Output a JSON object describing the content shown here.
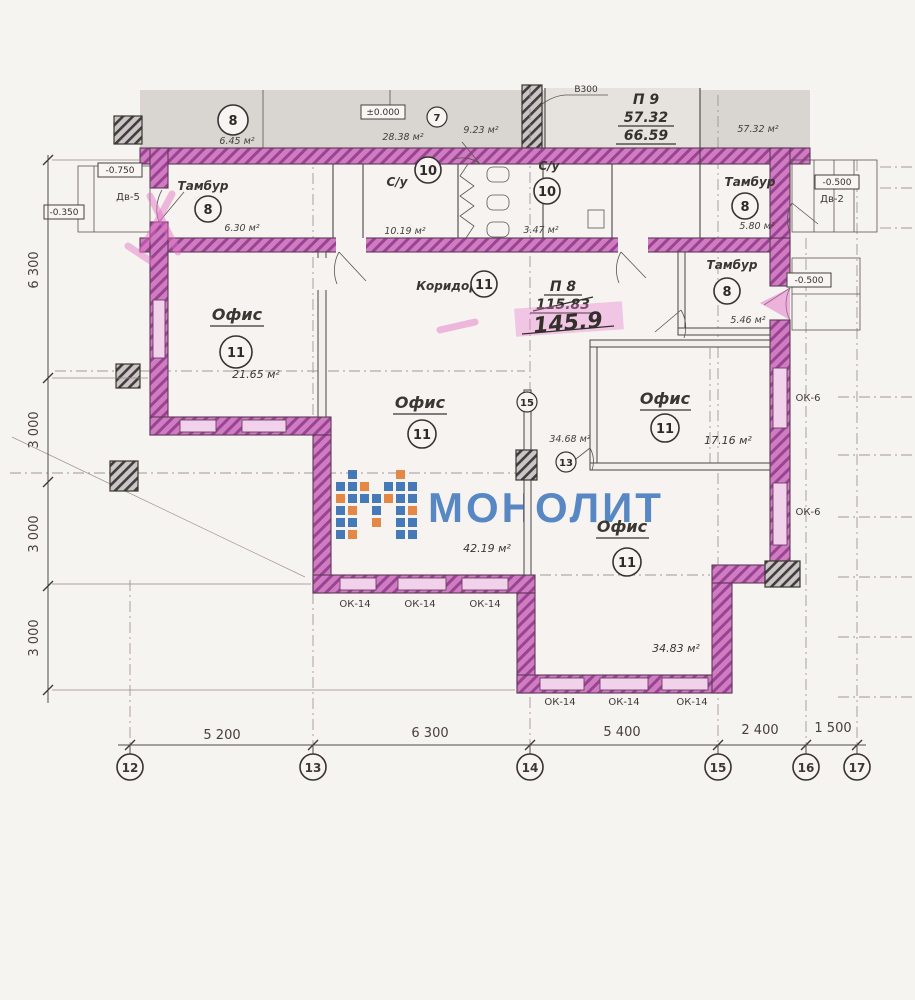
{
  "watermark": {
    "text": "МОНОЛИТ",
    "blue": "#3c72b4",
    "orange": "#e2823c"
  },
  "colors": {
    "wall_highlight": "#c766b4",
    "wall_hatch": "#9a4394",
    "window": "#f2d2ea",
    "linework": "#4a4540",
    "grey_band": "#d9d5d1"
  },
  "top": {
    "room8": {
      "num": "8",
      "area": "6.45 м²"
    },
    "area1": "28.38 м²",
    "area2": "9.23 м²",
    "level": "±0.000",
    "door7": "7",
    "note": "В300",
    "p9": {
      "label": "П 9",
      "top": "57.32",
      "bottom": "66.59"
    },
    "area_right": "57.32 м²"
  },
  "rooms": {
    "tambur_left": {
      "label": "Тамбур",
      "num": "8",
      "area": "6.30 м²"
    },
    "su_center": {
      "label": "С/у",
      "num": "10",
      "area": "10.19 м²"
    },
    "su_right": {
      "label": "С/у",
      "num": "10",
      "area": "3.47 м²"
    },
    "tambur_topright": {
      "label": "Тамбур",
      "num": "8",
      "area": "5.80 м²"
    },
    "tambur_right": {
      "label": "Тамбур",
      "num": "8",
      "area": "5.46 м²"
    },
    "corridor": {
      "label": "Коридор",
      "num": "11"
    },
    "office_left": {
      "label": "Офис",
      "num": "11",
      "area": "21.65 м²"
    },
    "office_center": {
      "label": "Офис",
      "num": "11",
      "area": "42.19 м²"
    },
    "office_right": {
      "label": "Офис",
      "num": "11",
      "area": "17.16 м²"
    },
    "office_bottom": {
      "label": "Офис",
      "num": "11",
      "area": "34.83 м²"
    },
    "area_mid": "34.68 м²"
  },
  "p8": {
    "label": "П 8",
    "old": "115.83",
    "new": "145.9"
  },
  "doors": {
    "dv5": "Дв-5",
    "dv2": "Дв-2",
    "m13": "13",
    "m15": "15"
  },
  "windows": {
    "ok14": "ОК-14",
    "ok6": "ОК-6"
  },
  "levels": {
    "left_upper": "-0.750",
    "left_lower": "-0.350",
    "right_top": "-0.500",
    "right_mid": "-0.500"
  },
  "dims": {
    "bottom": [
      "5 200",
      "6 300",
      "5 400",
      "2 400",
      "1 500"
    ],
    "axes": [
      "12",
      "13",
      "14",
      "15",
      "16",
      "17"
    ],
    "left": [
      "6 300",
      "3 000",
      "3 000",
      "3 000"
    ]
  }
}
